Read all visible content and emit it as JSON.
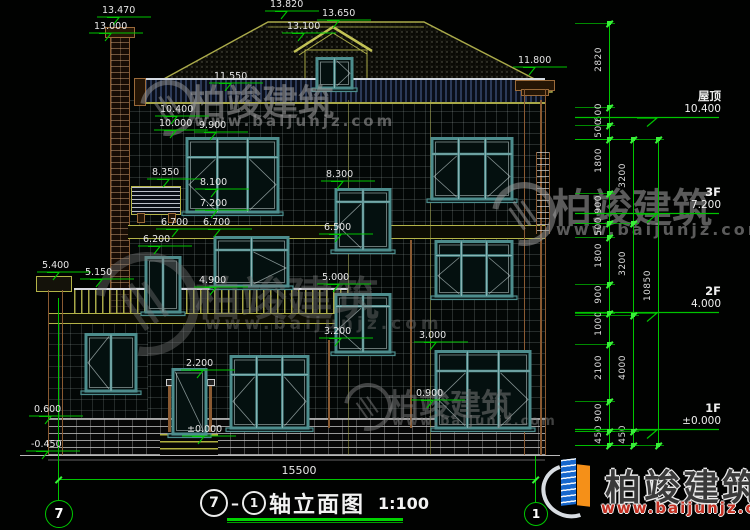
{
  "watermark": {
    "brand": "柏竣建筑",
    "site": "www.baijunjz.com"
  },
  "title": {
    "axis_left": "7",
    "axis_right": "1",
    "name": "轴立面图",
    "scale": "1:100"
  },
  "ground_dimension": "15500",
  "colors": {
    "dimension_green": "#00c400",
    "tick_green": "#39f039",
    "window_teal": "#4d8d8d",
    "band_olive": "#a8a848",
    "brick_brown": "#8a5a32",
    "text": "#e6e6e6",
    "logo_blue": "#1767cc",
    "logo_orange": "#f59018",
    "site_red": "#c43022"
  },
  "drawing": {
    "floor_labels": [
      {
        "name": "屋顶",
        "elev": "10.400",
        "y": 120
      },
      {
        "name": "3F",
        "elev": "7.200",
        "y": 216
      },
      {
        "name": "2F",
        "elev": "4.000",
        "y": 315
      },
      {
        "name": "1F",
        "elev": "±0.000",
        "y": 432
      }
    ],
    "elevation_marks": [
      {
        "v": "13.470",
        "x": 97,
        "y": 6
      },
      {
        "v": "13.000",
        "x": 89,
        "y": 22
      },
      {
        "v": "13.820",
        "x": 265,
        "y": 0
      },
      {
        "v": "13.650",
        "x": 317,
        "y": 9
      },
      {
        "v": "13.100",
        "x": 282,
        "y": 22
      },
      {
        "v": "11.800",
        "x": 513,
        "y": 56
      },
      {
        "v": "11.550",
        "x": 209,
        "y": 72
      },
      {
        "v": "10.400",
        "x": 155,
        "y": 105
      },
      {
        "v": "10.000",
        "x": 154,
        "y": 119
      },
      {
        "v": "9.900",
        "x": 194,
        "y": 121
      },
      {
        "v": "8.350",
        "x": 147,
        "y": 168
      },
      {
        "v": "8.100",
        "x": 195,
        "y": 178
      },
      {
        "v": "8.300",
        "x": 321,
        "y": 170
      },
      {
        "v": "7.200",
        "x": 195,
        "y": 199
      },
      {
        "v": "6.700",
        "x": 156,
        "y": 218
      },
      {
        "v": "6.700",
        "x": 198,
        "y": 218
      },
      {
        "v": "6.200",
        "x": 138,
        "y": 235
      },
      {
        "v": "6.500",
        "x": 319,
        "y": 223
      },
      {
        "v": "5.400",
        "x": 37,
        "y": 261
      },
      {
        "v": "5.150",
        "x": 80,
        "y": 268
      },
      {
        "v": "4.900",
        "x": 194,
        "y": 276
      },
      {
        "v": "5.000",
        "x": 317,
        "y": 273
      },
      {
        "v": "3.200",
        "x": 319,
        "y": 327
      },
      {
        "v": "3.000",
        "x": 414,
        "y": 331
      },
      {
        "v": "2.200",
        "x": 181,
        "y": 359
      },
      {
        "v": "0.900",
        "x": 411,
        "y": 389
      },
      {
        "v": "0.600",
        "x": 29,
        "y": 405
      },
      {
        "v": "-0.450",
        "x": 26,
        "y": 440
      },
      {
        "v": "±0.000",
        "x": 182,
        "y": 425
      }
    ],
    "dim_chains": [
      {
        "x": 609,
        "labelX": 594,
        "stubX": 575,
        "stubW": 40,
        "ticks": [
          23,
          107,
          125,
          139,
          193,
          223,
          237,
          284,
          313,
          344,
          401,
          431,
          445
        ],
        "labels": [
          "2820",
          "600",
          "500",
          "1800",
          "900",
          "500",
          "1800",
          "900",
          "1000",
          "2100",
          "900",
          "450"
        ]
      },
      {
        "x": 633,
        "labelX": 618,
        "stubX": 575,
        "stubW": 64,
        "ticks": [
          139,
          223,
          315,
          431,
          445
        ],
        "labels": [
          "3200",
          "3200",
          "4000",
          "450"
        ]
      },
      {
        "x": 658,
        "labelX": 643,
        "stubX": 575,
        "stubW": 89,
        "ticks": [
          139,
          445
        ],
        "labels": [
          "10850"
        ]
      }
    ],
    "windows": [
      {
        "name": "dormer-window",
        "x": 317,
        "y": 57,
        "w": 35,
        "h": 31,
        "cols": 2,
        "transom": 0,
        "diag": [
          1
        ]
      },
      {
        "name": "window-3f-left",
        "x": 187,
        "y": 137,
        "w": 91,
        "h": 75,
        "cols": 3,
        "transom": 0.25,
        "diag": [
          0,
          2
        ]
      },
      {
        "name": "window-3f-right",
        "x": 432,
        "y": 137,
        "w": 80,
        "h": 62,
        "cols": 3,
        "transom": 0.25,
        "diag": [
          0,
          2
        ]
      },
      {
        "name": "window-stair-upper",
        "x": 336,
        "y": 188,
        "w": 54,
        "h": 62,
        "cols": 2,
        "transom": 0.2,
        "diag": [
          0
        ]
      },
      {
        "name": "window-2f-left",
        "x": 215,
        "y": 236,
        "w": 73,
        "h": 50,
        "cols": 2,
        "transom": 0.25,
        "diag": [
          1
        ]
      },
      {
        "name": "window-2f-right",
        "x": 436,
        "y": 240,
        "w": 76,
        "h": 56,
        "cols": 3,
        "transom": 0.25,
        "diag": [
          0,
          2
        ]
      },
      {
        "name": "window-stair-lower",
        "x": 336,
        "y": 293,
        "w": 54,
        "h": 59,
        "cols": 2,
        "transom": 0.2,
        "diag": [
          0
        ]
      },
      {
        "name": "window-1f-left",
        "x": 231,
        "y": 355,
        "w": 77,
        "h": 73,
        "cols": 3,
        "transom": 0.25,
        "diag": [
          0,
          2
        ]
      },
      {
        "name": "window-1f-right",
        "x": 436,
        "y": 350,
        "w": 94,
        "h": 78,
        "cols": 3,
        "transom": 0.25,
        "diag": [
          0,
          2
        ]
      },
      {
        "name": "window-wing",
        "x": 86,
        "y": 333,
        "w": 50,
        "h": 58,
        "cols": 2,
        "transom": 0,
        "diag": [
          0
        ]
      },
      {
        "name": "window-narrow-left",
        "x": 146,
        "y": 256,
        "w": 34,
        "h": 56,
        "cols": 2,
        "transom": 0,
        "diag": []
      },
      {
        "name": "entry-door",
        "x": 173,
        "y": 368,
        "w": 33,
        "h": 66,
        "cols": 1,
        "transom": 0,
        "diag": [
          0
        ],
        "door": true
      }
    ]
  }
}
